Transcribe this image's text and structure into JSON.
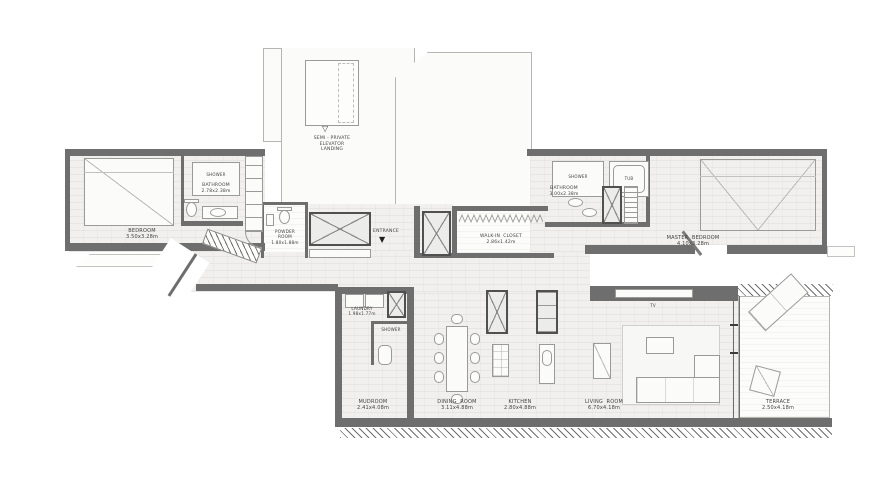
{
  "colors": {
    "wall": "#6e6e6e",
    "wall_dark": "#505050",
    "floor": "#f1f0ee",
    "plank": "#fcfcfb",
    "text": "#3f3f3f"
  },
  "landing": {
    "icon": "▽",
    "line1": "SEMI - PRIVATE",
    "line2": "ELEVATOR",
    "line3": "LANDING"
  },
  "entrance": {
    "label": "ENTRANCE",
    "icon": "▼"
  },
  "rooms": {
    "bedroom": {
      "name": "BEDROOM",
      "dims": "3.50x3.28m"
    },
    "bathroom": {
      "name": "BATHROOM",
      "dims": "2.78x2.38m",
      "shower": "SHOWER"
    },
    "powder_room": {
      "line1": "POWDER",
      "line2": "ROOM",
      "dims": "1.80x1.88m"
    },
    "walk_in_closet": {
      "name": "WALK-IN  CLOSET",
      "dims": "2.86x1.42m"
    },
    "master_bathroom": {
      "name": "BATHROOM",
      "dims": "3.00x2.38m",
      "shower": "SHOWER",
      "tub": "TUB"
    },
    "master_bedroom": {
      "name": "MASTER  BEDROOM",
      "dims": "4.10x3.28m"
    },
    "laundry": {
      "name": "LAUNDRY",
      "dims": "1.98x1.77m"
    },
    "lower_shower": {
      "name": "SHOWER"
    },
    "mudroom": {
      "name": "MUDROOM",
      "dims": "2.41x4.08m"
    },
    "dining_room": {
      "name": "DINING  ROOM",
      "dims": "3.11x4.88m"
    },
    "kitchen": {
      "name": "KITCHEN",
      "dims": "2.80x4.88m"
    },
    "living_room": {
      "name": "LIVING  ROOM",
      "dims": "6.70x4.18m",
      "tv": "TV"
    },
    "terrace": {
      "name": "TERRACE",
      "dims": "2.50x4.18m"
    }
  }
}
